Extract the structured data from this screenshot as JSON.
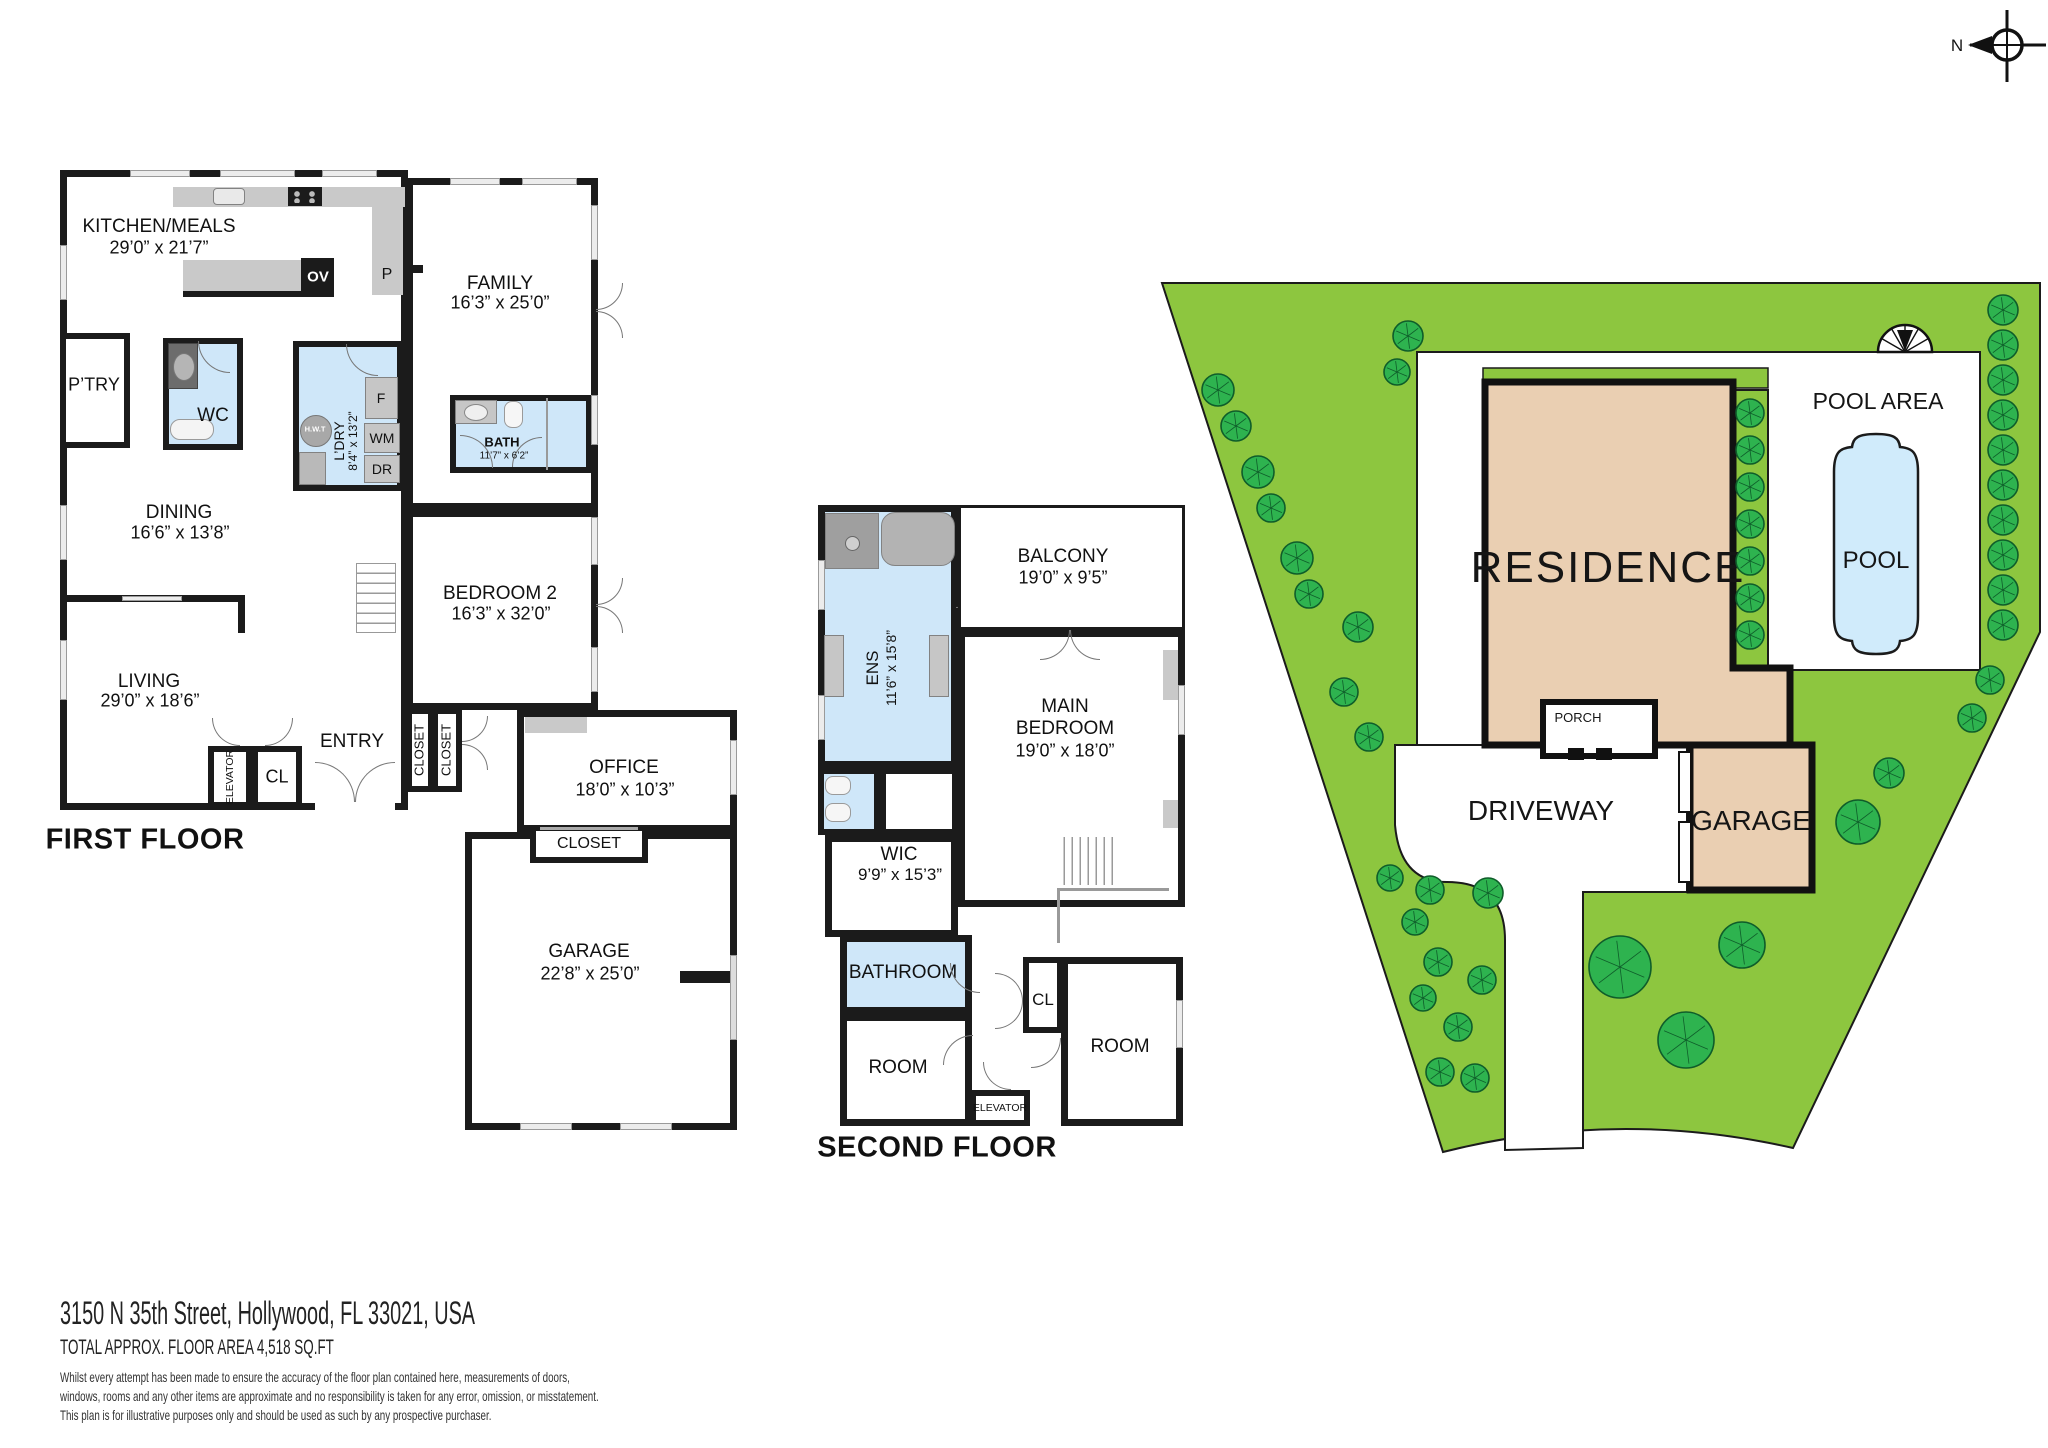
{
  "page": {
    "address": "3150 N 35th Street, Hollywood, FL 33021, USA",
    "area": "TOTAL APPROX. FLOOR AREA 4,518 SQ.FT",
    "disclaimer1": "Whilst every attempt has been made to ensure the accuracy of the floor plan contained here, measurements of doors,",
    "disclaimer2": "windows, rooms and any other items are approximate and no responsibility is taken for any error, omission, or misstatement.",
    "disclaimer3": "This plan is for illustrative purposes only and should be used as such by any prospective purchaser."
  },
  "compass": {
    "north": "N"
  },
  "first": {
    "title": "FIRST FLOOR",
    "kitchen_name": "KITCHEN/MEALS",
    "kitchen_dims": "29’0” x 21’7”",
    "family_name": "FAMILY",
    "family_dims": "16’3” x 25’0”",
    "pantry": "P’TRY",
    "p": "P",
    "ov": "OV",
    "wc": "WC",
    "ldry_name": "L’DRY",
    "ldry_dims": "8’4” x 13’2”",
    "hwt": "H.W.T",
    "f": "F",
    "wm": "WM",
    "dr": "DR",
    "bath_name": "BATH",
    "bath_dims": "11’7” x 6’2”",
    "dining_name": "DINING",
    "dining_dims": "16’6” x 13’8”",
    "living_name": "LIVING",
    "living_dims": "29’0” x 18’6”",
    "bedroom2_name": "BEDROOM 2",
    "bedroom2_dims": "16’3” x 32’0”",
    "entry": "ENTRY",
    "elevator": "ELEVATOR",
    "cl": "CL",
    "closet1": "CLOSET",
    "closet2": "CLOSET",
    "office_name": "OFFICE",
    "office_dims": "18’0” x 10’3”",
    "office_closet": "CLOSET",
    "garage_name": "GARAGE",
    "garage_dims": "22’8” x 25’0”"
  },
  "second": {
    "title": "SECOND FLOOR",
    "ens_name": "ENS",
    "ens_dims": "11’6” x 15’8”",
    "balcony_name": "BALCONY",
    "balcony_dims": "19’0” x 9’5”",
    "main_l1": "MAIN",
    "main_l2": "BEDROOM",
    "main_dims": "19’0” x 18’0”",
    "wic_name": "WIC",
    "wic_dims": "9’9” x 15’3”",
    "bathroom": "BATHROOM",
    "room_a": "ROOM",
    "cl": "CL",
    "room_b": "ROOM",
    "elevator": "ELEVATOR"
  },
  "site": {
    "residence": "RESIDENCE",
    "pool_area": "POOL AREA",
    "pool": "POOL",
    "porch": "PORCH",
    "driveway": "DRIVEWAY",
    "garage": "GARAGE"
  },
  "colors": {
    "lawn": "#8dc63f",
    "tree": "#2eb34f",
    "tan": "#eacfb2",
    "pool": "#d0ebfb",
    "wet": "#cfe7f9",
    "wall": "#1b1b1b"
  }
}
